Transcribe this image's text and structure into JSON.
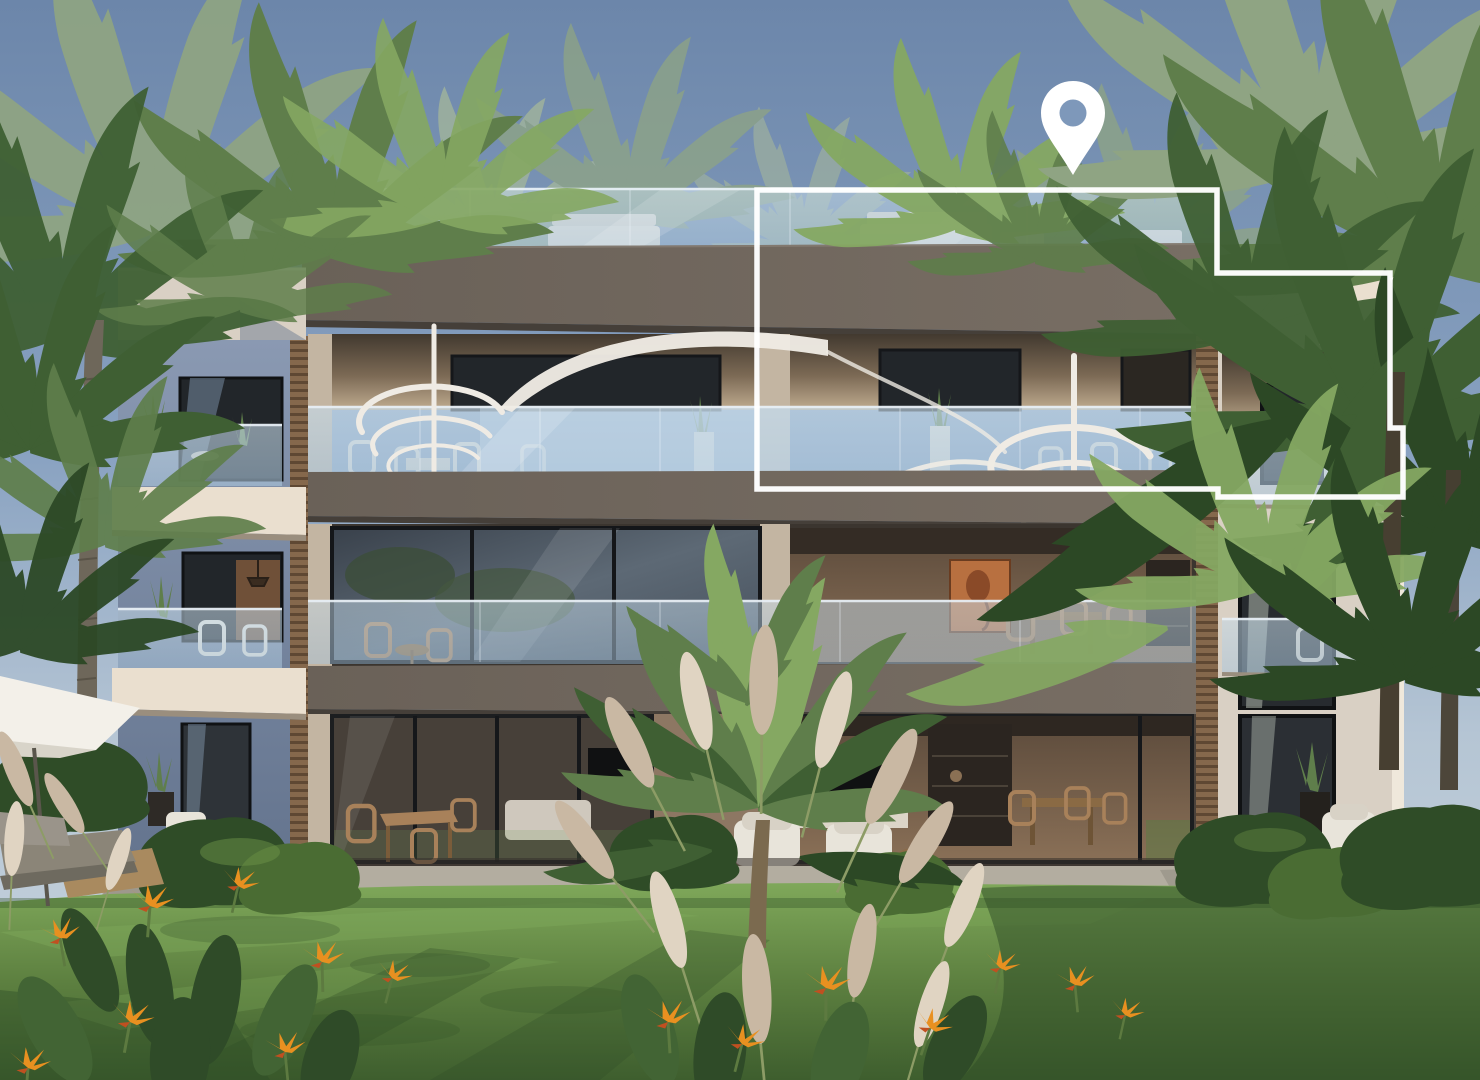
{
  "canvas": {
    "width": 1480,
    "height": 1080
  },
  "scene": {
    "type": "architectural-exterior-render",
    "building": {
      "floors_visible": 3,
      "regions": [
        "roof-terrace",
        "penthouse-floor",
        "middle-floor",
        "ground-floor",
        "left-wing",
        "right-wing",
        "garden-lawn"
      ]
    },
    "marker": {
      "icon": "location-pin-icon",
      "points_at": "penthouse-unit"
    },
    "highlight": {
      "shape": "unit-outline",
      "style": "white-border",
      "unit": "top-floor-right-with-roof-terrace"
    }
  },
  "colors": {
    "sky_top": "#6c86aa",
    "sky_mid": "#89a2c1",
    "sky_low": "#b5c5d4",
    "sky_horizon": "#c9d5de",
    "glass_tint": "#aac5db",
    "glass_bright": "#c6dae8",
    "rail_white": "#e9f0f6",
    "fascia": "#6a6158",
    "fascia_light": "#786e64",
    "fascia_under": "#453f39",
    "cream": "#d9d0c4",
    "cream_bright": "#eadfcf",
    "cream_shade": "#c3b5a2",
    "wing_wall": "#8a99b2",
    "wing_wall_dark": "#64748e",
    "window_dark": "#22262a",
    "frame_dark": "#131518",
    "recess_dark": "#42392f",
    "recess_warm": "#c0ac90",
    "warm_int": "#8a7057",
    "warm_int_dark": "#5b4a3b",
    "artwork": "#b87040",
    "artwork_dark": "#8a4a28",
    "wood_slat": "#85684c",
    "wood_slat_dark": "#5f4833",
    "stair_white": "#efebe4",
    "furn_white": "#e8e4da",
    "chair_wood": "#a8815a",
    "tv_black": "#101112",
    "console": "#dcd5c8",
    "shelf": "#2b2520",
    "terrace": "#b3ada0",
    "terrace_shade": "#8c877b",
    "lawn_sun": "#7fa85a",
    "lawn_mid": "#5d8040",
    "lawn_dark": "#3e5e2e",
    "lawn_shadow": "#2e4c26",
    "bush_dark": "#2f4c27",
    "bush_mid": "#4a6c33",
    "bush_light": "#6c9247",
    "palm_back": "#8fa483",
    "palm_soft": "#a5b79a",
    "palm_mid": "#5f7e4b",
    "palm_bright": "#85a862",
    "palm_dark": "#3f5f33",
    "palm_deep": "#2c4825",
    "trunk": "#6e675a",
    "trunk_dark": "#473f31",
    "pampas": "#c9b8a3",
    "pampas_light": "#e0d4c2",
    "pampas_stem": "#8d9c66",
    "flower_orange": "#e89020",
    "flower_red": "#c05020",
    "leaf_dark": "#2f4b28",
    "leaf_mid": "#426434",
    "umbrella": "#f3f0e9",
    "umbrella_shade": "#d8d4c9",
    "lounger": "#8b8578",
    "lounger_side": "#6e6a5f",
    "lounger_wood": "#a98a5f",
    "pin": "#ffffff",
    "pin_hole": "#7e98ba",
    "outline": "#ffffff"
  }
}
